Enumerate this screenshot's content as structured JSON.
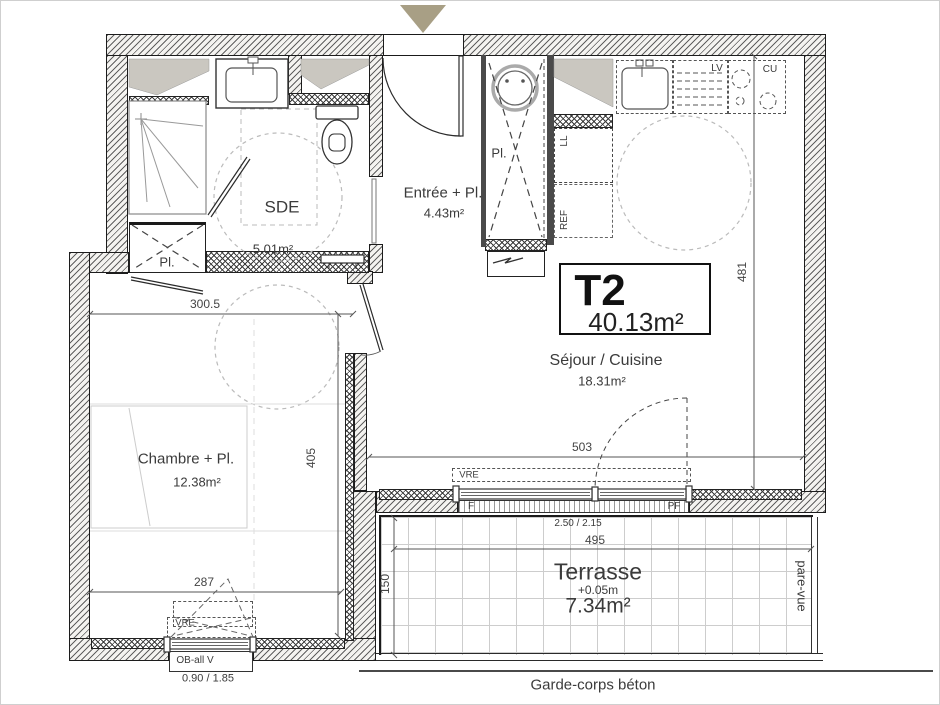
{
  "title_block": {
    "type": "T2",
    "area": "40.13m²"
  },
  "rooms": {
    "sde": {
      "name": "SDE",
      "area": "5.01m²"
    },
    "entree": {
      "name": "Entrée + Pl.",
      "area": "4.43m²"
    },
    "sejour": {
      "name": "Séjour / Cuisine",
      "area": "18.31m²"
    },
    "chambre": {
      "name": "Chambre + Pl.",
      "area": "12.38m²"
    },
    "terrasse": {
      "name": "Terrasse",
      "level": "+0.05m",
      "area": "7.34m²"
    }
  },
  "closets": {
    "sde": "Pl.",
    "entree": "Pl."
  },
  "appliances": {
    "washing_machine": "LL",
    "fridge": "REF",
    "dishwasher": "LV",
    "cooktop": "CU"
  },
  "openings": {
    "sejour_shutter": "VRE",
    "chambre_shutter": "VRE",
    "window_fixed": "F",
    "window_door": "PF",
    "chambre_window_type": "OB-all V",
    "chambre_window_size": "0.90 / 1.85",
    "sejour_window_size": "2.50 / 2.15"
  },
  "dimensions": {
    "chambre_width": "300.5",
    "chambre_depth": "405",
    "chambre_window_width": "287",
    "sejour_depth": "481",
    "sejour_width": "503",
    "terrasse_width": "495",
    "terrasse_depth": "150"
  },
  "annotations": {
    "railing": "Garde-corps béton",
    "privacy_screen": "pare-vue"
  },
  "colors": {
    "entrance_arrow": "#a89f85",
    "duct_fill": "#cac7c0",
    "wall_line": "#1c1c1c",
    "dash_gray": "#bbbbbb"
  }
}
